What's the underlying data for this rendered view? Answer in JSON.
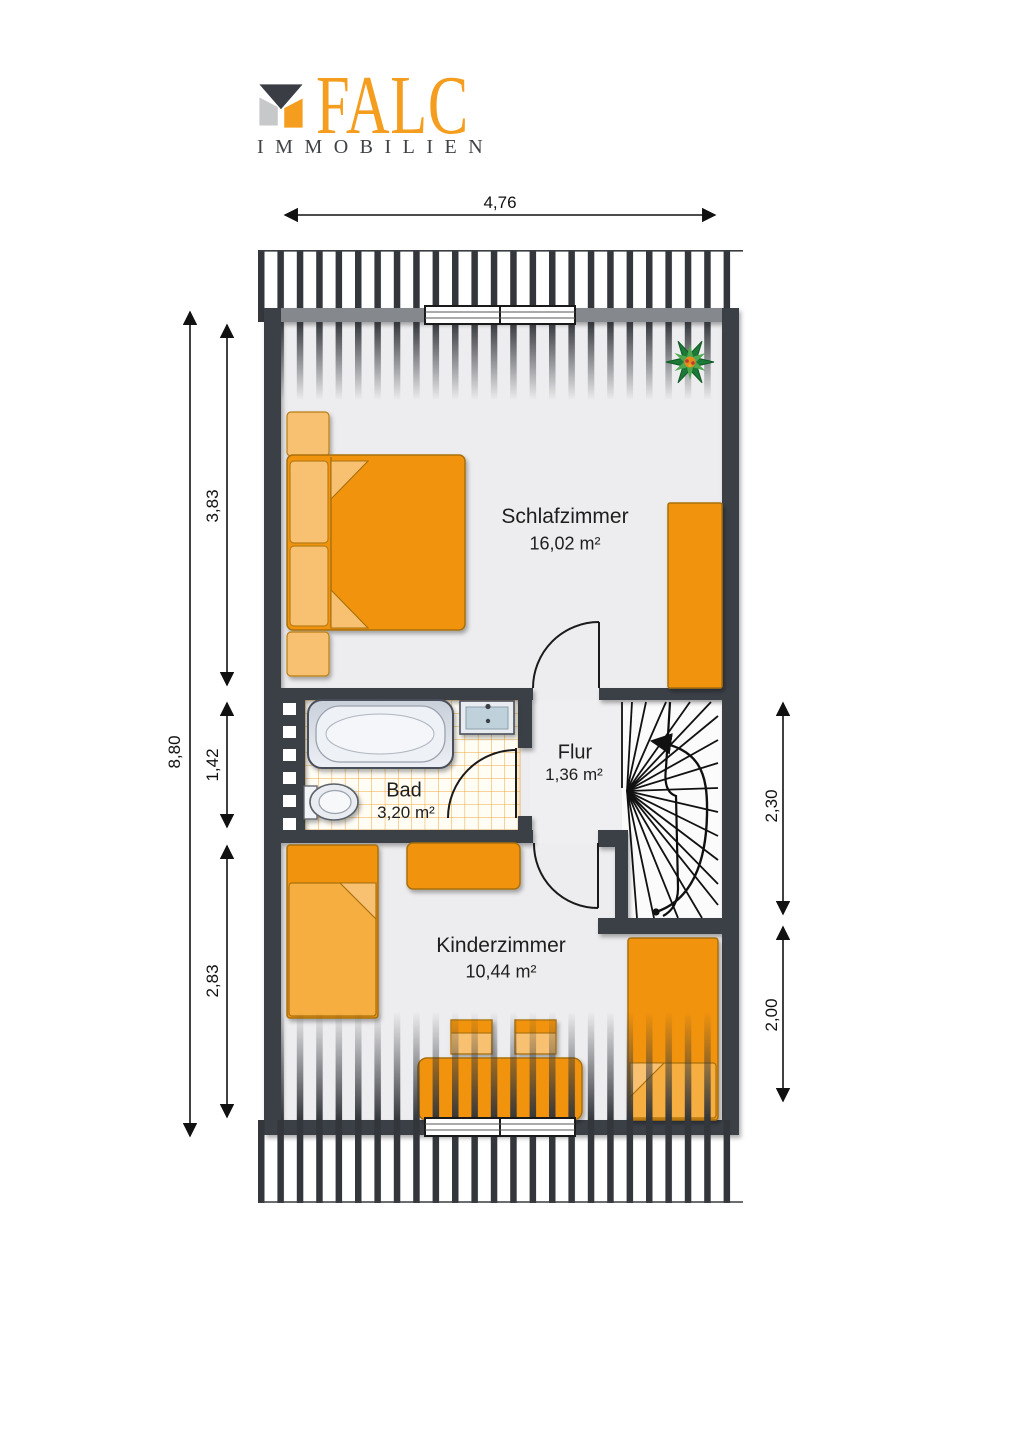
{
  "brand": {
    "logo_text": "FALC",
    "logo_subtext": "IMMOBILIEN"
  },
  "rooms": [
    {
      "id": "schlafzimmer",
      "name": "Schlafzimmer",
      "area": "16,02 m²"
    },
    {
      "id": "bad",
      "name": "Bad",
      "area": "3,20 m²"
    },
    {
      "id": "flur",
      "name": "Flur",
      "area": "1,36 m²"
    },
    {
      "id": "kinderzimmer",
      "name": "Kinderzimmer",
      "area": "10,44 m²"
    }
  ],
  "dimensions": {
    "top_width": "4,76",
    "left_total": "8,80",
    "left_upper": "3,83",
    "left_middle": "1,42",
    "left_lower": "2,83",
    "right_upper": "2,30",
    "right_lower": "2,00"
  },
  "colors": {
    "brand_orange": "#F59D1E",
    "brand_gray": "#3F4347",
    "wall_dark": "#3B4046",
    "wall_top_gray": "#85888C",
    "furniture_orange": "#F1930F",
    "furniture_light_orange": "#F8C172",
    "floor_gray": "#EDEDEF",
    "tile_line_orange": "#EFA73E",
    "plant_green": "#1C7A36"
  }
}
